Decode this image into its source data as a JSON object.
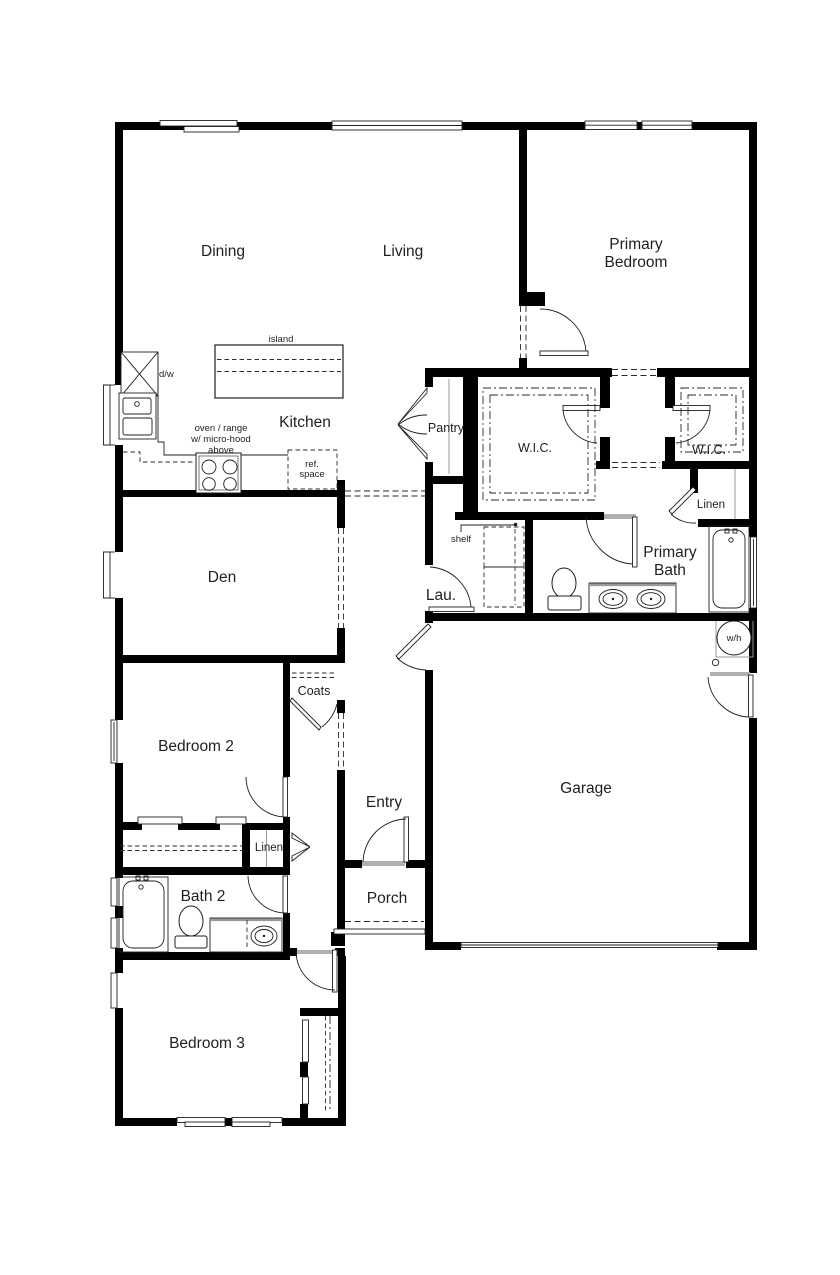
{
  "plan": {
    "title": "single-story house floor plan",
    "rooms": {
      "dining": "Dining",
      "living": "Living",
      "primary_bedroom_line1": "Primary",
      "primary_bedroom_line2": "Bedroom",
      "kitchen": "Kitchen",
      "pantry": "Pantry",
      "wic_left": "W.I.C.",
      "wic_right": "W.I.C.",
      "linen_primary": "Linen",
      "primary_bath_line1": "Primary",
      "primary_bath_line2": "Bath",
      "den": "Den",
      "laundry": "Lau.",
      "bedroom2": "Bedroom 2",
      "coats": "Coats",
      "entry": "Entry",
      "garage": "Garage",
      "linen_hall": "Linen",
      "bath2": "Bath 2",
      "porch": "Porch",
      "bedroom3": "Bedroom 3"
    },
    "annotations": {
      "island": "island",
      "dishwasher": "d/w",
      "range_note_line1": "oven / range",
      "range_note_line2": "w/ micro-hood",
      "range_note_line3": "above",
      "ref_line1": "ref.",
      "ref_line2": "space",
      "shelf": "shelf",
      "water_heater": "w/h"
    },
    "colors": {
      "wall": "#000000",
      "line": "#1f1f1f",
      "gray": "#b0b0b0",
      "background": "#ffffff",
      "text": "#1f1f1f"
    }
  }
}
